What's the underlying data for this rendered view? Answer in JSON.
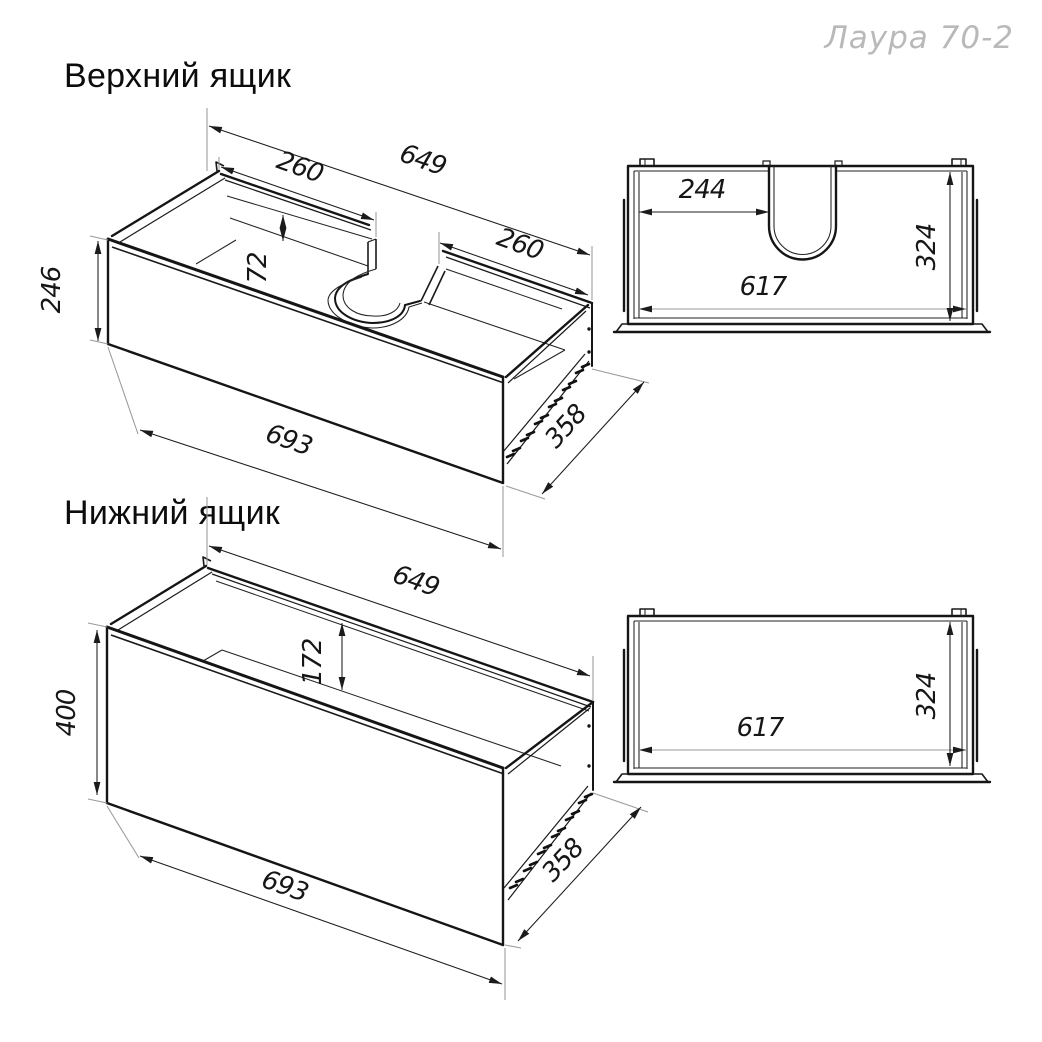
{
  "brand": "Лаура 70-2",
  "colors": {
    "line": "#1a1a1a",
    "extension_line": "#9a9a9a",
    "brand_text": "#b9b9b9"
  },
  "upper": {
    "title": "Верхний ящик",
    "iso": {
      "back_width": "649",
      "left_section": "260",
      "right_section": "260",
      "cutout_height": "72",
      "front_height": "246",
      "front_width": "693",
      "side_depth": "358"
    },
    "plan": {
      "left_offset": "244",
      "inner_width": "617",
      "inner_depth": "324"
    }
  },
  "lower": {
    "title": "Нижний ящик",
    "iso": {
      "back_width": "649",
      "back_height": "172",
      "front_height": "400",
      "front_width": "693",
      "side_depth": "358"
    },
    "plan": {
      "inner_width": "617",
      "inner_depth": "324"
    }
  }
}
